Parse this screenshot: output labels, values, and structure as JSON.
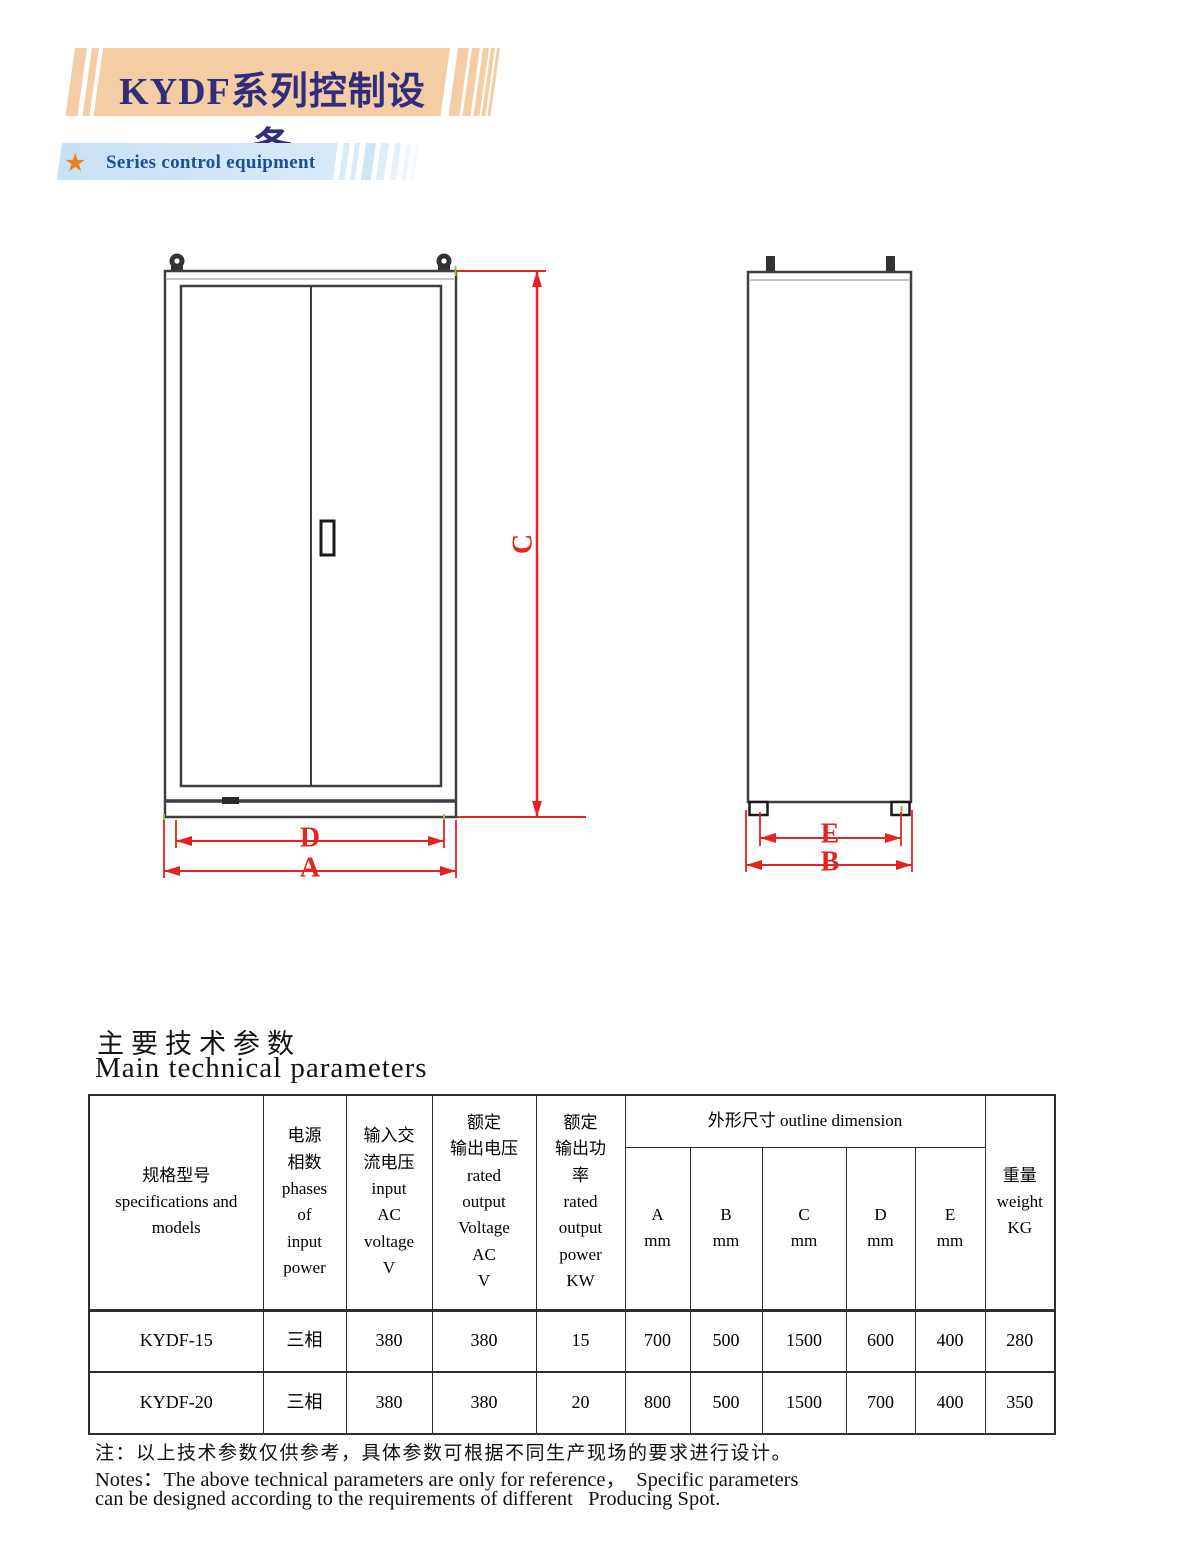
{
  "header": {
    "title": "KYDF系列控制设备",
    "subtitle": "Series control equipment",
    "star_icon": "★",
    "colors": {
      "banner": "#f5cda4",
      "title_text": "#312d7d",
      "subtitle_bar": "#cfe4f6",
      "subtitle_text": "#1b4e9b",
      "star": "#ef7f1c"
    }
  },
  "drawing": {
    "colors": {
      "outline": "#3f3f3f",
      "dimension": "#e52321",
      "datum_tick": "#8cc63f"
    },
    "labels": {
      "height": "C",
      "front_inner_width": "D",
      "front_outer_width": "A",
      "side_inner_depth": "E",
      "side_outer_depth": "B"
    }
  },
  "section": {
    "title_zh": "主要技术参数",
    "title_en": "Main technical parameters"
  },
  "table": {
    "header": {
      "specs": "规格型号\nspecifications and\nmodels",
      "phases": "电源\n相数\nphases\nof\ninput\npower",
      "input_voltage": "输入交\n流电压\ninput\nAC\nvoltage\nV",
      "output_voltage": "额定\n输出电压\nrated\noutput\nVoltage\nAC\nV",
      "output_power": "额定\n输出功\n率\nrated\noutput\npower\nKW",
      "outline": "外形尺寸 outline dimension",
      "dim_a": "A\nmm",
      "dim_b": "B\nmm",
      "dim_c": "C\nmm",
      "dim_d": "D\nmm",
      "dim_e": "E\nmm",
      "weight": "重量\nweight\nKG"
    },
    "rows": [
      {
        "model": "KYDF-15",
        "phases": "三相",
        "input_v": "380",
        "output_v": "380",
        "power_kw": "15",
        "a": "700",
        "b": "500",
        "c": "1500",
        "d": "600",
        "e": "400",
        "weight": "280"
      },
      {
        "model": "KYDF-20",
        "phases": "三相",
        "input_v": "380",
        "output_v": "380",
        "power_kw": "20",
        "a": "800",
        "b": "500",
        "c": "1500",
        "d": "700",
        "e": "400",
        "weight": "350"
      }
    ]
  },
  "notes": {
    "line1": "注：以上技术参数仅供参考，具体参数可根据不同生产现场的要求进行设计。",
    "line2": "Notes：The above technical parameters are only for reference，  Specific parameters",
    "line3": "can be designed according to the requirements of different   Producing Spot."
  }
}
